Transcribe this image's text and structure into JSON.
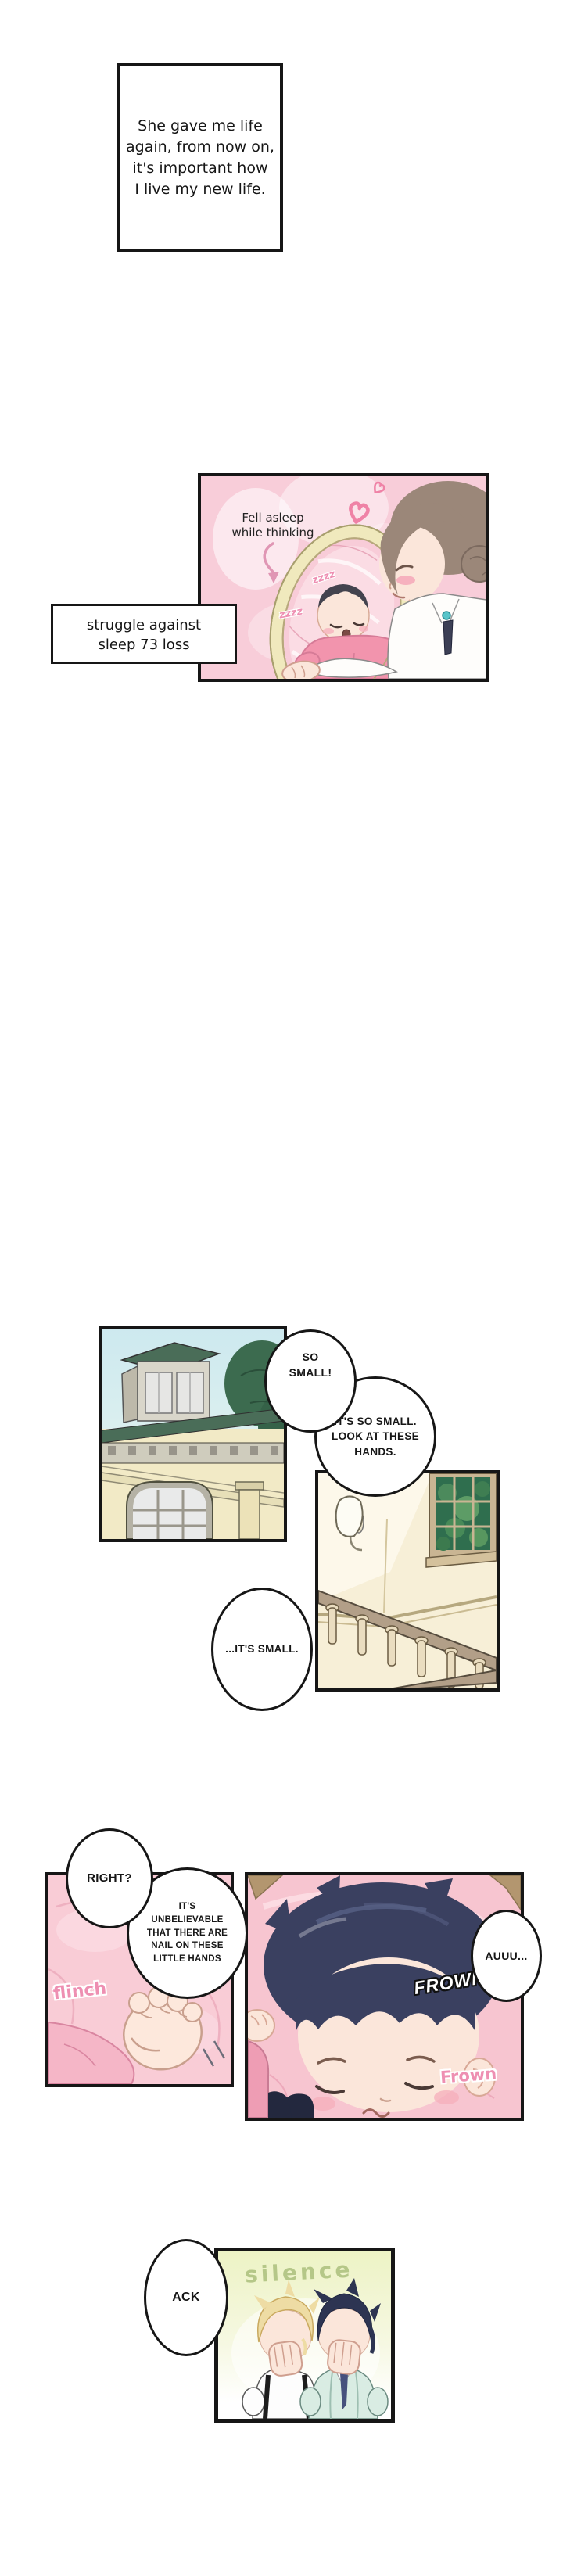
{
  "colors": {
    "page_bg": "#ffffff",
    "ink": "#161616",
    "bubble_bg": "#ffffff",
    "nursery_bg": "#f8cdd9",
    "sfx_pink": "#ee8fb2",
    "heart_pink": "#ef82a6",
    "arrow_pink": "#e096b4",
    "bassinet_cream": "#f0e9bd",
    "nurse_hair_brown": "#9b8779",
    "brooch_teal": "#57c4c9",
    "sky_top": "#cde9ef",
    "sky_bottom": "#eaf6ef",
    "building_cream": "#f2eac6",
    "roof_green": "#4a6d58",
    "cornice_gray": "#cfccbd",
    "window_glass": "#e9eaea",
    "interior_wall": "#f7efd7",
    "window_frame_tan": "#c9b593",
    "foliage_green": "#2f6e4e",
    "rail_wood": "#b29f88",
    "spindle_cream": "#eaddc0",
    "fist_panel_bg": "#f9ccd6",
    "skin": "#fde8dc",
    "sleeve_pink": "#f5b6c7",
    "baby_panel_bg": "#f7c5d0",
    "baby_hair_navy": "#3a4060",
    "hair_highlight": "#565f84",
    "face_skin": "#fbe6da",
    "blush_pink": "#f6aebb",
    "parent_hair_tan": "#b3966f",
    "silence_bg": "#edf3c5",
    "silence_text_green": "#b5c788",
    "blonde_hair": "#eedca4",
    "dark_hair_navy": "#2d3452",
    "mint_cardigan": "#d9ece3",
    "tie_navy": "#46517d"
  },
  "narration": {
    "lines": [
      "She gave me life",
      "again, from now on,",
      "it's important how",
      "I live my new life."
    ]
  },
  "nursery": {
    "caption_lines": [
      "Fell asleep",
      "while thinking"
    ],
    "sfx_zzz_a": "zzzz",
    "sfx_zzz_b": "zzzz",
    "note_lines": [
      "struggle against",
      "sleep 73 loss"
    ]
  },
  "observation": {
    "bubble_so_small_lines": [
      "SO",
      "SMALL!"
    ],
    "bubble_look_lines": [
      "IT'S SO SMALL.",
      "LOOK AT THESE",
      "HANDS."
    ],
    "bubble_its_small": "...IT'S SMALL."
  },
  "hands": {
    "bubble_right": "RIGHT?",
    "bubble_unbelievable_lines": [
      "IT'S",
      "UNBELIEVABLE",
      "THAT THERE ARE",
      "NAIL ON THESE",
      "LITTLE HANDS"
    ],
    "sfx_flinch": "flinch",
    "sfx_frown_caps": "FROWN",
    "sfx_frown_small": "Frown",
    "bubble_auuu": "AUUU..."
  },
  "finale": {
    "bubble_ack": "ACK",
    "sfx_silence": "silence"
  }
}
